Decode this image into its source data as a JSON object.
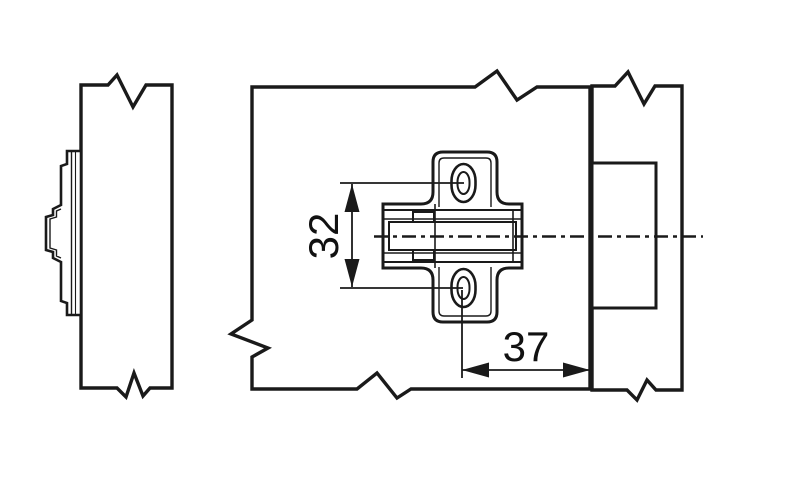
{
  "drawing": {
    "dimensions": {
      "vertical": {
        "label": "32"
      },
      "horizontal": {
        "label": "37"
      }
    },
    "colors": {
      "panel": "#dcd5c1",
      "panel_light": "#ebe9da",
      "line": "#1a1a1a",
      "plate_fill": "#ffffff",
      "background": "#ffffff"
    }
  }
}
